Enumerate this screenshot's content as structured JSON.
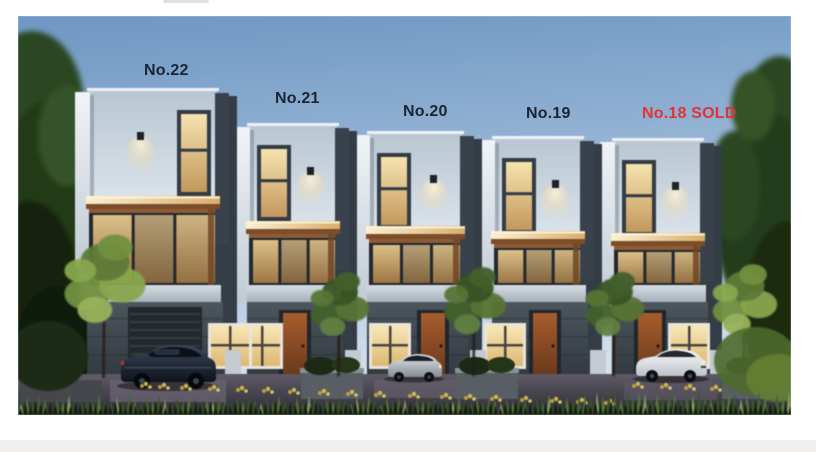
{
  "page": {
    "background_color": "#ffffff",
    "footer_strip_color": "#f2f0ee"
  },
  "render": {
    "description": "Dusk 3D architectural rendering of a row of five modern three-storey townhouses with warm lit windows, landscaped frontage, small trees and parked cars",
    "sky_top_color": "#6e97c3",
    "sky_mid_color": "#a3bedb",
    "sky_horizon_color": "#dbe6f0",
    "label_color": "#1b2433",
    "sold_color": "#e03338",
    "labels": [
      {
        "text": "No.22",
        "status": "available"
      },
      {
        "text": "No.21",
        "status": "available"
      },
      {
        "text": "No.20",
        "status": "available"
      },
      {
        "text": "No.19",
        "status": "available"
      },
      {
        "text": "No.18 SOLD",
        "status": "sold"
      }
    ]
  }
}
